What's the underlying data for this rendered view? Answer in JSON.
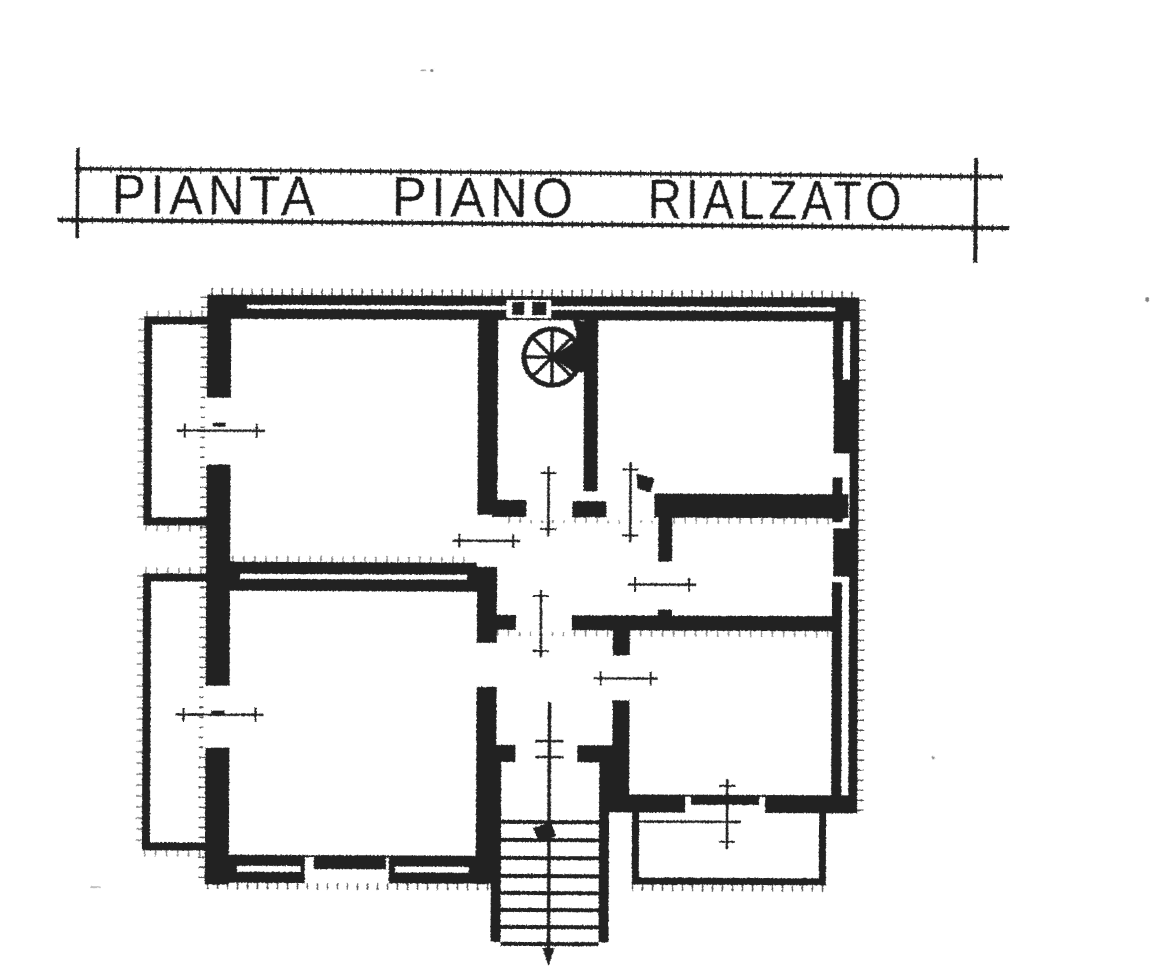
{
  "document": {
    "kind": "scanned architectural floor plan drawing",
    "paper_color": "#ffffff",
    "ink_color": "#212121"
  },
  "title": {
    "text": "PIANTA PIANO RIALZATO",
    "words": [
      "PIANTA",
      "PIANO",
      "RIALZATO"
    ]
  },
  "plan": {
    "features": [
      "hatched-masonry-walls",
      "spiral-staircase",
      "entrance-stairs-with-direction-line",
      "balcony-upper-left",
      "balcony-lower-left",
      "terrace-lower-right",
      "window-centerline-marks",
      "door-opening-marks",
      "wall-flue-notch"
    ]
  },
  "icons": [
    {
      "name": "spiral-staircase-icon",
      "shape": "circle with radial treads and filled wedge"
    },
    {
      "name": "stair-direction-arrow-icon",
      "shape": "small filled triangle"
    },
    {
      "name": "door-swing-flag-icon",
      "shape": "small filled pennant"
    },
    {
      "name": "stair-start-marker-icon",
      "shape": "small filled blob on first tread"
    }
  ]
}
